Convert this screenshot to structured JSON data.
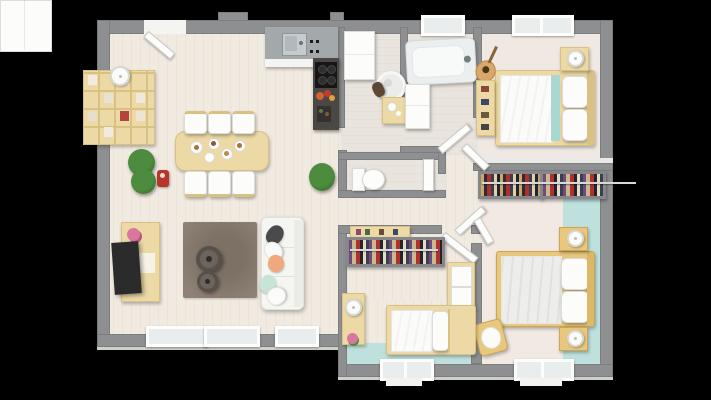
{
  "meta": {
    "description": "Top-down 3D rendered floor plan of a 3-bedroom single-storey house on a black background",
    "canvas": {
      "width": 711,
      "height": 400
    },
    "visible_text": ""
  },
  "palette": {
    "bg": "#000000",
    "wall": "#8e8f91",
    "wallface": "#e9e9e7",
    "floor": "#f1eae1",
    "floor_bath": "#e9e4dd",
    "floor_bed1": "#f0e8e2",
    "floor_bed2": "#f1e9e2",
    "teal": "#bfe1dd",
    "teal_stripe": "#a8d8cf",
    "wood": "#ecd9a6",
    "wood_dark": "#d9c184",
    "wood_tan": "#e9c87e",
    "counter": "#a3a8ab",
    "dark_unit": "#4b4745",
    "cooktop": "#161616",
    "rug": "#8e8276",
    "sofa": "#f5f5f2",
    "pillow_gray": "#4a4a4c",
    "peach": "#f0a97e",
    "mint": "#c7e5d6",
    "green": "#4d8c3f",
    "green_dark": "#2f6428",
    "tv": "#2c2b2c",
    "red": "#b8352c",
    "white": "#fcfcfb",
    "glass": "#e9edee",
    "rack_base": "#5a5c60",
    "rack_frame": "#85878a"
  },
  "rooms": [
    {
      "id": "living_dining_kitchen",
      "label": "Open-plan living / dining / kitchen"
    },
    {
      "id": "bathroom",
      "label": "Bathroom with round basin and vanity"
    },
    {
      "id": "shower_room",
      "label": "Shower room with bathtub"
    },
    {
      "id": "wc",
      "label": "Separate WC"
    },
    {
      "id": "hallway",
      "label": "Central hallway with door fan"
    },
    {
      "id": "bedroom_1",
      "label": "Bedroom 1 (top right, double bed with teal throw)"
    },
    {
      "id": "dressing",
      "label": "Dressing corridor with two clothes racks"
    },
    {
      "id": "bedroom_2",
      "label": "Bedroom 2 (bottom right, teal floor band)"
    },
    {
      "id": "bedroom_3",
      "label": "Bedroom 3 (bottom middle, child room with single bed)"
    }
  ],
  "furniture": {
    "entry_door": {
      "label": "entry door (open)"
    },
    "kitchen_tall_cabinet": {
      "label": "tall white kitchen cabinet / fridge unit"
    },
    "kitchen_counter": {
      "label": "kitchen counter with gray worktop"
    },
    "kitchen_sink": {
      "label": "stainless steel sink"
    },
    "kitchen_hob_column": {
      "label": "dark unit with black cooktop, flowers and bottles"
    },
    "dining_table": {
      "label": "light wood dining table with plates"
    },
    "dining_chair": {
      "label": "white dining chair"
    },
    "cube_shelf": {
      "label": "wall-mounted cube bookshelf"
    },
    "shelf_lamp": {
      "label": "white lamp on shelf"
    },
    "plant_large": {
      "label": "large green plant"
    },
    "plant_small": {
      "label": "green plant"
    },
    "red_item": {
      "label": "small red cart"
    },
    "tv_stand": {
      "label": "light wood TV stand with pink flowers"
    },
    "tv": {
      "label": "flat screen TV"
    },
    "rug": {
      "label": "taupe rug"
    },
    "coffee_table_large": {
      "label": "round coffee table (large)"
    },
    "coffee_table_small": {
      "label": "round coffee table (small)"
    },
    "sofa": {
      "label": "white sofa with gray, white, peach and mint cushions"
    },
    "bath_cabinet": {
      "label": "white bathroom cabinet"
    },
    "round_basin": {
      "label": "round basin with mirror and towel"
    },
    "wood_vanity": {
      "label": "wooden vanity unit"
    },
    "bathtub": {
      "label": "bathtub with faucet"
    },
    "shower_cabinet": {
      "label": "tall white storage cabinet"
    },
    "toilet": {
      "label": "toilet"
    },
    "wardrobe_rack_1": {
      "label": "open wardrobe rack with clothes"
    },
    "wardrobe_rack_2": {
      "label": "open wardrobe rack with clothes"
    },
    "clothes_rail": {
      "label": "clothes rail"
    },
    "bed1": {
      "label": "double bed, wood frame, white duvet with teal stripe"
    },
    "bed1_nightstand": {
      "label": "nightstand with white lamp"
    },
    "guitar": {
      "label": "guitar leaning in corner"
    },
    "bed1_shelf": {
      "label": "narrow wooden shelf with books"
    },
    "bed2": {
      "label": "double bed, tan frame, gray-white duvet, two pillows"
    },
    "bed2_nightstand_top": {
      "label": "nightstand with white lamp"
    },
    "bed2_nightstand_bottom": {
      "label": "nightstand with white lamp"
    },
    "bed2_chair": {
      "label": "wooden chair with white cushion"
    },
    "bed3_rack": {
      "label": "open wardrobe rack with clothes"
    },
    "bed3_shelf": {
      "label": "wall shelf with books"
    },
    "bed3_wardrobe": {
      "label": "wooden wardrobe with white doors"
    },
    "bed3_desk": {
      "label": "small desk with lamp and flowers"
    },
    "bed3_bed": {
      "label": "single bed with white duvet and pillow"
    },
    "window": {
      "label": "window"
    }
  }
}
